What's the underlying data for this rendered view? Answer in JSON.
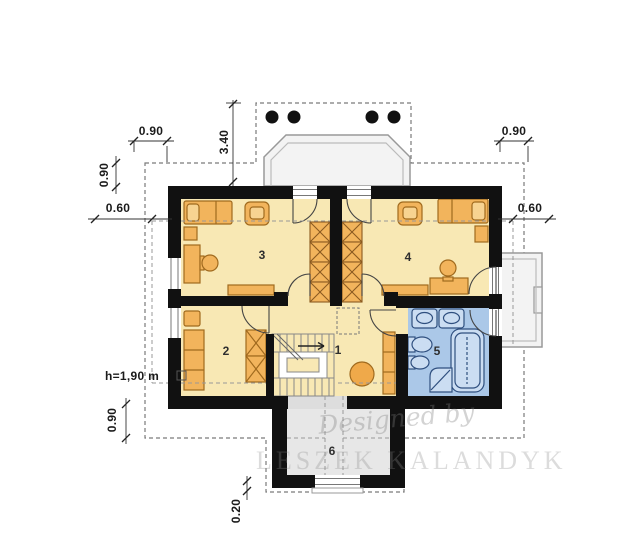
{
  "rooms": [
    {
      "number": "1"
    },
    {
      "number": "2"
    },
    {
      "number": "3"
    },
    {
      "number": "4"
    },
    {
      "number": "5"
    },
    {
      "number": "6"
    }
  ],
  "dimensions": {
    "top_left": "0.90",
    "top_right": "0.90",
    "upper_left": "0.90",
    "mid_left": "0.60",
    "mid_right": "0.60",
    "balcony_depth": "3.40",
    "lower_left": "0.90",
    "bottom_step": "0.20",
    "headroom": "h=1,90 m"
  },
  "watermark": {
    "script": "Designed by",
    "name": "LESZEK KALANDYK"
  },
  "colors": {
    "floor": "#F8E8B4",
    "furniture": "#F2B45C",
    "bathroom_floor": "#ABC8E8",
    "fixtures": "#CBDDF2",
    "wall": "#111111",
    "annex": "#E7E7E7",
    "balcony": "#F3F3F3",
    "dash": "#888888"
  }
}
